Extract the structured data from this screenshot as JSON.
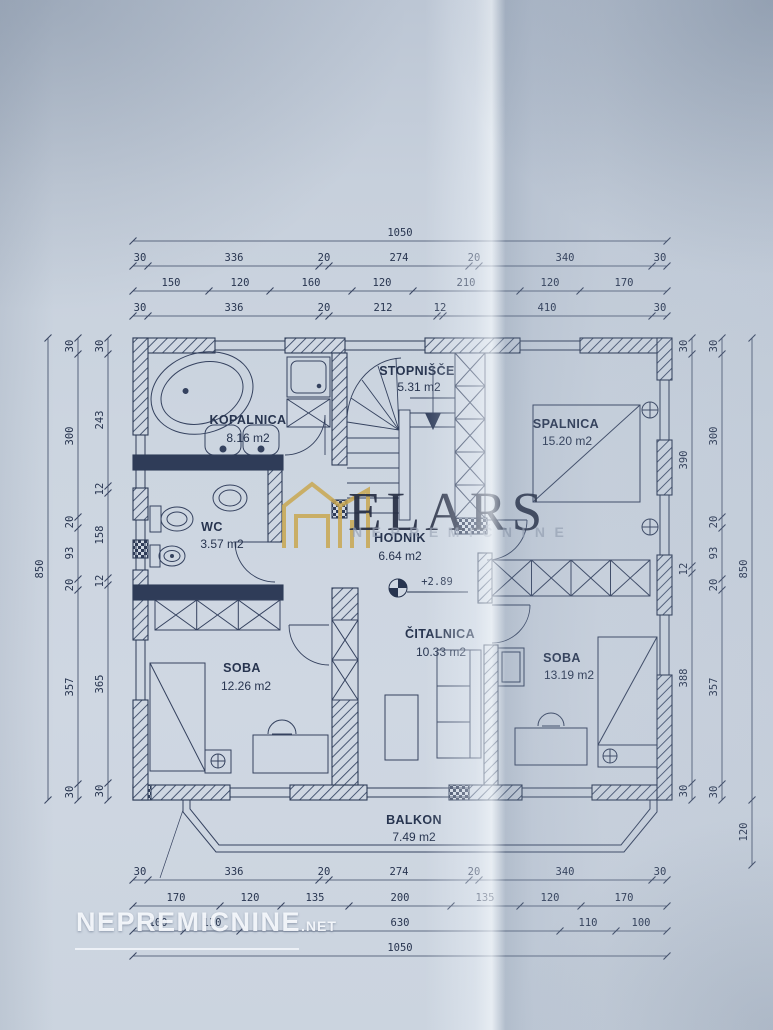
{
  "document": {
    "type": "floor-plan-photo",
    "paper_color": "#ccd5e0",
    "ink_color": "#35425f",
    "gold_accent": "#c9a851"
  },
  "rooms": {
    "kopalnica": {
      "name": "KOPALNICA",
      "area": "8.16 m2"
    },
    "stopnisce": {
      "name": "STOPNIŠČE",
      "area": "5.31 m2"
    },
    "spalnica": {
      "name": "SPALNICA",
      "area": "15.20 m2"
    },
    "wc": {
      "name": "WC",
      "area": "3.57 m2"
    },
    "hodnik": {
      "name": "HODNIK",
      "area": "6.64 m2"
    },
    "soba1": {
      "name": "SOBA",
      "area": "12.26 m2"
    },
    "citalnica": {
      "name": "ČITALNICA",
      "area": "10.33 m2"
    },
    "soba2": {
      "name": "SOBA",
      "area": "13.19 m2"
    },
    "balkon": {
      "name": "BALKON",
      "area": "7.49 m2"
    }
  },
  "level": {
    "marker": "+2.89"
  },
  "dims": {
    "top": {
      "row1": [
        "1050"
      ],
      "row2": [
        "30",
        "336",
        "20",
        "274",
        "20",
        "340",
        "30"
      ],
      "row3": [
        "150",
        "120",
        "160",
        "120",
        "210",
        "120",
        "170"
      ],
      "row4": [
        "30",
        "336",
        "20",
        "212",
        "12",
        "410",
        "30"
      ]
    },
    "bottom": {
      "row1": [
        "30",
        "336",
        "20",
        "274",
        "20",
        "340",
        "30"
      ],
      "row2": [
        "170",
        "120",
        "135",
        "200",
        "135",
        "120",
        "170"
      ],
      "row3": [
        "100",
        "110",
        "630",
        "110",
        "100"
      ],
      "row4": [
        "1050"
      ]
    },
    "left": {
      "outer": [
        "850"
      ],
      "middle": [
        "30",
        "300",
        "20",
        "93",
        "20",
        "357",
        "30"
      ],
      "inner": [
        "30",
        "243",
        "12",
        "158",
        "12",
        "365",
        "30"
      ]
    },
    "right": {
      "inner": [
        "30",
        "390",
        "12",
        "388",
        "30"
      ],
      "middle": [
        "30",
        "300",
        "20",
        "93",
        "20",
        "357",
        "30"
      ],
      "outer": [
        "850",
        "120"
      ]
    }
  },
  "watermarks": {
    "agency": {
      "title": "ELARS",
      "subtitle": "NEPREMIČNINE"
    },
    "portal": {
      "name": "NEPREMICNINE",
      "tld": ".NET"
    }
  }
}
